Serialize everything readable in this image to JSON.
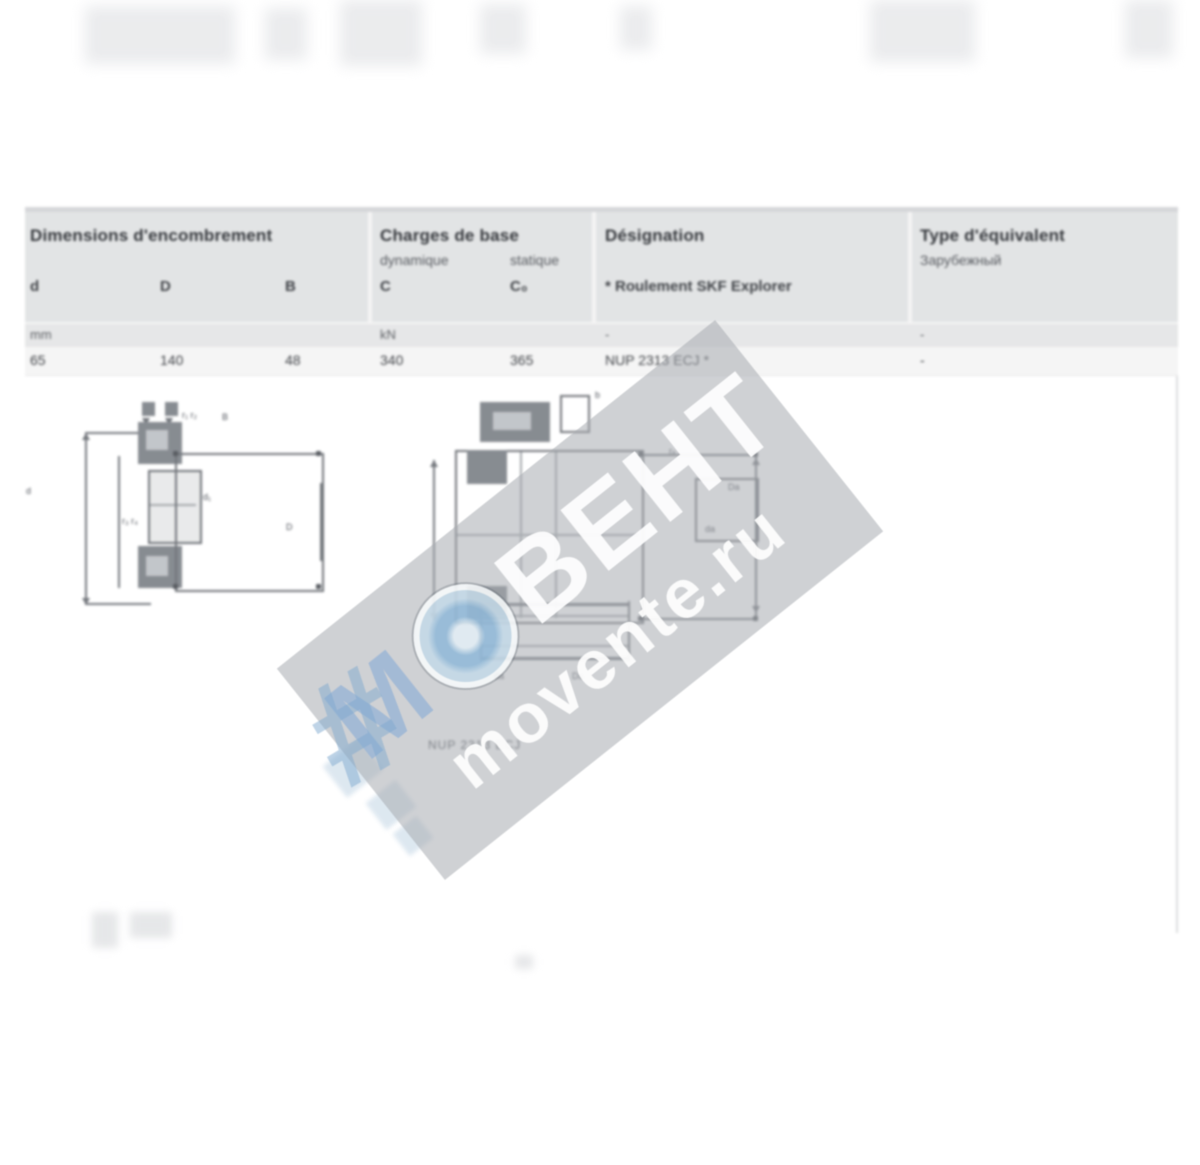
{
  "table": {
    "groups": [
      {
        "title": "Dimensions d'encombrement"
      },
      {
        "title": "Charges de base",
        "sub_left": "dynamique",
        "sub_right": "statique"
      },
      {
        "title": "Désignation",
        "sub": "* Roulement SKF Explorer"
      },
      {
        "title": "Type d'équivalent",
        "sub": "Зарубежный"
      }
    ],
    "symbols": [
      "d",
      "D",
      "B",
      "C",
      "C₀"
    ],
    "units": [
      "mm",
      "kN",
      "-",
      "-"
    ],
    "row": {
      "d": "65",
      "D": "140",
      "B": "48",
      "C": "340",
      "C0": "365",
      "designation": "NUP 2313 ECJ *",
      "equivalent": "-"
    }
  },
  "drawings": {
    "caption": "NUP 2313 ECJ",
    "labels": {
      "r12": "r₁ r₂",
      "B": "B",
      "d": "d",
      "d1": "d₁",
      "D": "D",
      "r34": "r₃ r₄",
      "b": "b",
      "ra": "rₐ",
      "Da": "Da",
      "da": "da"
    }
  },
  "watermark": {
    "m": "М",
    "hash": "#",
    "rest": "ВЕНТ",
    "site": "movente.ru",
    "band_color": "rgba(167,171,176,0.55)",
    "accent_blue": "#8fb3d4"
  }
}
